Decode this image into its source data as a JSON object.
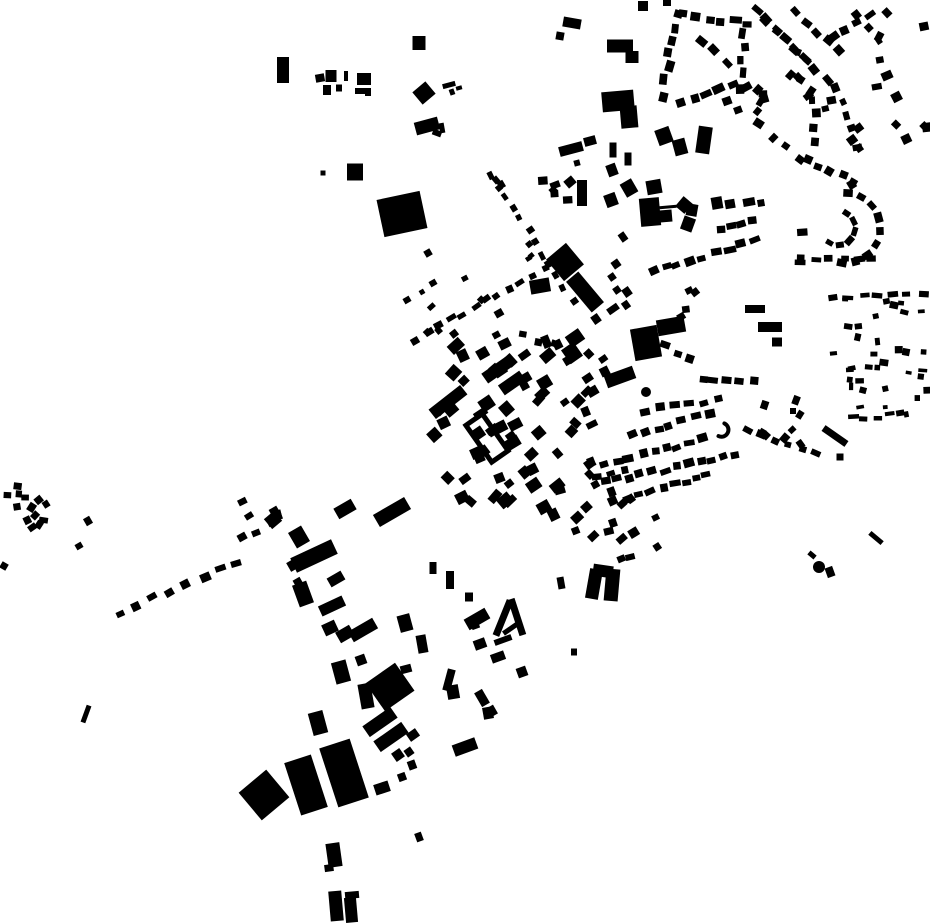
{
  "map": {
    "description": "black-and-white figure-ground map of building footprints of a town, black buildings on white background, no text or labels visible",
    "canvas": {
      "width": 930,
      "height": 924,
      "background": "#ffffff",
      "building_color": "#000000"
    },
    "seed": 7,
    "legend": {
      "buildings": "[cx, cy, w, h, rotationDeg] explicit footprint rectangles",
      "rows": "[x1, y1, x2, y2, count, w, h] houses evenly spaced along a street segment, oriented along it",
      "arcs": "[cx, cy, r, a1Deg, a2Deg, count, w, h] houses along a curved street (loop / cul-de-sac)",
      "scatters": "[x, y, boxW, boxH, count, minSize, maxSize, angleDeg, angleJitterDeg] loose clusters of houses",
      "circles": "[cx, cy, r] round structures",
      "rings": "[cx, cy, w, h, rotationDeg, strokeW] courtyard block outline",
      "crescents": "[cx, cy, r, a1Deg, a2Deg, strokeW] crescent-shaped building"
    },
    "buildings": [
      [
        283,
        70,
        12,
        26,
        0
      ],
      [
        320,
        78,
        9,
        8,
        -10
      ],
      [
        331,
        76,
        11,
        12,
        0
      ],
      [
        327,
        90,
        8,
        10,
        0
      ],
      [
        339,
        88,
        6,
        7,
        0
      ],
      [
        346,
        76,
        4,
        10,
        0
      ],
      [
        364,
        79,
        14,
        12,
        0
      ],
      [
        360,
        91,
        10,
        6,
        0
      ],
      [
        368,
        92,
        6,
        8,
        0
      ],
      [
        419,
        43,
        13,
        14,
        0
      ],
      [
        424,
        93,
        17,
        16,
        -40
      ],
      [
        449,
        85,
        13,
        5,
        -15
      ],
      [
        459,
        88,
        6,
        4,
        -15
      ],
      [
        427,
        126,
        24,
        13,
        -15
      ],
      [
        437,
        133,
        9,
        6,
        20
      ],
      [
        355,
        172,
        16,
        17,
        0
      ],
      [
        323,
        173,
        5,
        5,
        0
      ],
      [
        402,
        214,
        44,
        38,
        -12
      ],
      [
        452,
        92,
        5,
        6,
        -20
      ],
      [
        442,
        128,
        5,
        10,
        -10
      ],
      [
        572,
        23,
        18,
        10,
        10
      ],
      [
        560,
        36,
        8,
        8,
        10
      ],
      [
        643,
        6,
        10,
        10,
        0
      ],
      [
        667,
        3,
        8,
        6,
        0
      ],
      [
        620,
        46,
        26,
        13,
        0
      ],
      [
        632,
        57,
        13,
        12,
        0
      ],
      [
        618,
        101,
        32,
        20,
        -5
      ],
      [
        629,
        117,
        17,
        22,
        -5
      ],
      [
        590,
        141,
        12,
        9,
        -15
      ],
      [
        571,
        149,
        24,
        10,
        -15
      ],
      [
        577,
        163,
        6,
        6,
        -15
      ],
      [
        613,
        150,
        7,
        15,
        0
      ],
      [
        628,
        159,
        7,
        13,
        0
      ],
      [
        612,
        170,
        10,
        12,
        -20
      ],
      [
        629,
        188,
        13,
        15,
        -30
      ],
      [
        611,
        200,
        12,
        13,
        -20
      ],
      [
        582,
        193,
        10,
        26,
        0
      ],
      [
        570,
        182,
        10,
        9,
        -40
      ],
      [
        553,
        190,
        7,
        6,
        -40
      ],
      [
        496,
        180,
        6,
        7,
        -40
      ],
      [
        499,
        188,
        6,
        6,
        -40
      ],
      [
        704,
        140,
        14,
        27,
        8
      ],
      [
        664,
        136,
        15,
        16,
        -20
      ],
      [
        680,
        147,
        13,
        16,
        -15
      ],
      [
        654,
        187,
        15,
        14,
        -10
      ],
      [
        650,
        212,
        20,
        28,
        -5
      ],
      [
        666,
        216,
        12,
        12,
        -5
      ],
      [
        668,
        207,
        17,
        3,
        -5
      ],
      [
        684,
        205,
        12,
        13,
        40
      ],
      [
        692,
        210,
        11,
        12,
        10
      ],
      [
        688,
        224,
        12,
        14,
        20
      ],
      [
        717,
        203,
        11,
        12,
        -10
      ],
      [
        730,
        204,
        10,
        9,
        -10
      ],
      [
        749,
        202,
        12,
        8,
        -10
      ],
      [
        761,
        203,
        7,
        7,
        -10
      ],
      [
        727,
        101,
        9,
        8,
        -20
      ],
      [
        738,
        110,
        8,
        7,
        -20
      ],
      [
        565,
        262,
        26,
        28,
        -40
      ],
      [
        585,
        292,
        16,
        40,
        -40
      ],
      [
        540,
        286,
        20,
        14,
        -10
      ],
      [
        616,
        264,
        8,
        8,
        -35
      ],
      [
        612,
        277,
        7,
        7,
        -35
      ],
      [
        617,
        290,
        7,
        7,
        -35
      ],
      [
        627,
        292,
        8,
        9,
        -35
      ],
      [
        626,
        305,
        7,
        8,
        -35
      ],
      [
        613,
        309,
        12,
        7,
        -35
      ],
      [
        596,
        319,
        8,
        9,
        -35
      ],
      [
        623,
        237,
        7,
        9,
        -35
      ],
      [
        646,
        343,
        27,
        32,
        -10
      ],
      [
        671,
        326,
        28,
        16,
        -10
      ],
      [
        620,
        377,
        30,
        13,
        -20
      ],
      [
        755,
        309,
        20,
        8,
        0
      ],
      [
        770,
        327,
        24,
        10,
        0
      ],
      [
        777,
        342,
        10,
        9,
        0
      ],
      [
        835,
        436,
        28,
        7,
        35
      ],
      [
        840,
        457,
        7,
        7,
        0
      ],
      [
        876,
        538,
        16,
        5,
        40
      ],
      [
        812,
        555,
        8,
        5,
        40
      ],
      [
        830,
        572,
        8,
        10,
        -20
      ],
      [
        793,
        411,
        6,
        6,
        0
      ],
      [
        572,
        353,
        15,
        17,
        -35
      ],
      [
        575,
        338,
        16,
        13,
        -35
      ],
      [
        497,
        370,
        30,
        12,
        -35
      ],
      [
        512,
        383,
        26,
        12,
        -35
      ],
      [
        448,
        402,
        40,
        12,
        -38
      ],
      [
        428,
        253,
        7,
        7,
        -30
      ],
      [
        433,
        283,
        7,
        6,
        -30
      ],
      [
        422,
        292,
        5,
        5,
        -30
      ],
      [
        407,
        300,
        7,
        6,
        -30
      ],
      [
        415,
        341,
        8,
        7,
        -30
      ],
      [
        345,
        509,
        20,
        12,
        -30
      ],
      [
        392,
        512,
        36,
        14,
        -30
      ],
      [
        299,
        537,
        15,
        18,
        -30
      ],
      [
        314,
        556,
        45,
        16,
        -25
      ],
      [
        303,
        594,
        15,
        23,
        -20
      ],
      [
        336,
        579,
        16,
        10,
        -30
      ],
      [
        332,
        606,
        26,
        11,
        -25
      ],
      [
        330,
        628,
        14,
        12,
        -25
      ],
      [
        345,
        634,
        16,
        12,
        -30
      ],
      [
        363,
        630,
        28,
        12,
        -30
      ],
      [
        341,
        672,
        15,
        22,
        -15
      ],
      [
        361,
        660,
        10,
        10,
        -20
      ],
      [
        390,
        687,
        36,
        34,
        -35
      ],
      [
        366,
        696,
        13,
        25,
        -10
      ],
      [
        318,
        723,
        15,
        23,
        -15
      ],
      [
        405,
        623,
        13,
        17,
        -15
      ],
      [
        422,
        644,
        10,
        18,
        -10
      ],
      [
        406,
        669,
        11,
        8,
        -15
      ],
      [
        380,
        722,
        34,
        13,
        -35
      ],
      [
        391,
        737,
        34,
        13,
        -35
      ],
      [
        398,
        755,
        10,
        10,
        -35
      ],
      [
        413,
        735,
        11,
        9,
        -35
      ],
      [
        409,
        752,
        8,
        8,
        -35
      ],
      [
        412,
        765,
        8,
        9,
        -20
      ],
      [
        402,
        777,
        8,
        8,
        -20
      ],
      [
        264,
        795,
        36,
        36,
        -40
      ],
      [
        306,
        785,
        28,
        55,
        -18
      ],
      [
        344,
        773,
        32,
        62,
        -18
      ],
      [
        347,
        787,
        7,
        7,
        -18
      ],
      [
        382,
        788,
        15,
        11,
        -18
      ],
      [
        419,
        837,
        7,
        9,
        -20
      ],
      [
        334,
        855,
        14,
        24,
        -8
      ],
      [
        329,
        868,
        9,
        7,
        -8
      ],
      [
        336,
        906,
        13,
        30,
        -5
      ],
      [
        352,
        895,
        14,
        7,
        -5
      ],
      [
        351,
        910,
        12,
        25,
        -5
      ],
      [
        449,
        680,
        8,
        22,
        15
      ],
      [
        453,
        692,
        12,
        14,
        -10
      ],
      [
        482,
        698,
        9,
        16,
        -30
      ],
      [
        492,
        711,
        8,
        10,
        -30
      ],
      [
        488,
        713,
        10,
        12,
        -10
      ],
      [
        465,
        747,
        24,
        12,
        -20
      ],
      [
        475,
        625,
        8,
        8,
        -20
      ],
      [
        480,
        644,
        12,
        10,
        -20
      ],
      [
        503,
        640,
        18,
        6,
        -20
      ],
      [
        498,
        657,
        14,
        9,
        -20
      ],
      [
        522,
        672,
        10,
        10,
        -20
      ],
      [
        450,
        580,
        8,
        18,
        0
      ],
      [
        469,
        597,
        8,
        9,
        0
      ],
      [
        433,
        568,
        7,
        12,
        0
      ],
      [
        574,
        652,
        6,
        7,
        0
      ],
      [
        561,
        583,
        7,
        12,
        -10
      ],
      [
        594,
        584,
        13,
        30,
        10
      ],
      [
        612,
        585,
        14,
        32,
        5
      ],
      [
        603,
        571,
        20,
        12,
        8
      ],
      [
        503,
        618,
        7,
        38,
        22
      ],
      [
        517,
        617,
        7,
        38,
        -18
      ],
      [
        510,
        629,
        16,
        5,
        -35
      ],
      [
        477,
        619,
        24,
        12,
        -30
      ],
      [
        88,
        521,
        7,
        8,
        -30
      ],
      [
        79,
        546,
        7,
        6,
        -30
      ],
      [
        86,
        714,
        5,
        18,
        20
      ],
      [
        4,
        566,
        7,
        7,
        30
      ],
      [
        293,
        565,
        10,
        10,
        -30
      ],
      [
        299,
        584,
        8,
        12,
        -30
      ],
      [
        273,
        520,
        13,
        13,
        -40
      ]
    ],
    "rows": [
      [
        663,
        95,
        676,
        14,
        7,
        9,
        7
      ],
      [
        684,
        14,
        748,
        24,
        6,
        10,
        7
      ],
      [
        744,
        32,
        741,
        88,
        5,
        9,
        7
      ],
      [
        681,
        103,
        733,
        84,
        5,
        10,
        7
      ],
      [
        700,
        41,
        726,
        62,
        3,
        9,
        7
      ],
      [
        757,
        10,
        826,
        80,
        8,
        10,
        7
      ],
      [
        766,
        22,
        816,
        68,
        6,
        9,
        7
      ],
      [
        797,
        12,
        838,
        52,
        5,
        9,
        7
      ],
      [
        858,
        14,
        880,
        40,
        3,
        9,
        7
      ],
      [
        832,
        38,
        872,
        15,
        4,
        9,
        7
      ],
      [
        808,
        160,
        853,
        180,
        5,
        9,
        7
      ],
      [
        814,
        100,
        816,
        140,
        4,
        8,
        7
      ],
      [
        836,
        90,
        850,
        130,
        4,
        8,
        7
      ],
      [
        758,
        125,
        800,
        160,
        4,
        8,
        7
      ],
      [
        800,
        262,
        872,
        259,
        6,
        9,
        6
      ],
      [
        803,
        232,
        803,
        255,
        2,
        6,
        9
      ],
      [
        652,
        272,
        755,
        242,
        9,
        10,
        7
      ],
      [
        720,
        227,
        752,
        222,
        4,
        9,
        7
      ],
      [
        664,
        346,
        692,
        358,
        3,
        9,
        7
      ],
      [
        702,
        377,
        752,
        381,
        5,
        9,
        7
      ],
      [
        646,
        411,
        716,
        399,
        6,
        9,
        7
      ],
      [
        633,
        436,
        708,
        413,
        7,
        9,
        7
      ],
      [
        605,
        465,
        703,
        440,
        9,
        9,
        7
      ],
      [
        599,
        476,
        627,
        469,
        3,
        8,
        6
      ],
      [
        605,
        483,
        737,
        455,
        12,
        9,
        7
      ],
      [
        627,
        498,
        708,
        473,
        8,
        9,
        7
      ],
      [
        748,
        428,
        815,
        455,
        6,
        8,
        7
      ],
      [
        790,
        430,
        800,
        443,
        2,
        7,
        6
      ],
      [
        492,
        174,
        572,
        300,
        12,
        7,
        6
      ],
      [
        545,
        268,
        427,
        333,
        11,
        8,
        6
      ],
      [
        523,
        336,
        553,
        345,
        3,
        9,
        7
      ],
      [
        120,
        613,
        237,
        563,
        8,
        9,
        7
      ],
      [
        240,
        537,
        272,
        524,
        3,
        8,
        7
      ],
      [
        835,
        297,
        922,
        293,
        7,
        10,
        5
      ],
      [
        852,
        418,
        900,
        415,
        5,
        9,
        5
      ]
    ],
    "arcs": [
      [
        845,
        228,
        35,
        -85,
        95,
        9,
        9,
        7
      ],
      [
        838,
        228,
        17,
        -60,
        120,
        6,
        8,
        6
      ]
    ],
    "scatters": [
      [
        746,
        85,
        46,
        30,
        5,
        7,
        10,
        -30,
        30
      ],
      [
        855,
        10,
        75,
        140,
        11,
        7,
        11,
        -35,
        30
      ],
      [
        805,
        85,
        65,
        100,
        6,
        7,
        10,
        -40,
        30
      ],
      [
        750,
        40,
        100,
        70,
        8,
        7,
        10,
        -40,
        30
      ],
      [
        540,
        170,
        35,
        42,
        4,
        7,
        10,
        -15,
        20
      ],
      [
        2,
        482,
        53,
        46,
        13,
        6,
        9,
        -30,
        40
      ],
      [
        238,
        500,
        42,
        20,
        5,
        7,
        9,
        -30,
        20
      ],
      [
        445,
        340,
        115,
        55,
        16,
        8,
        15,
        -35,
        15
      ],
      [
        430,
        390,
        115,
        60,
        18,
        8,
        15,
        -35,
        15
      ],
      [
        440,
        450,
        120,
        70,
        20,
        8,
        14,
        -35,
        15
      ],
      [
        545,
        350,
        65,
        120,
        16,
        7,
        12,
        -35,
        15
      ],
      [
        555,
        470,
        85,
        75,
        12,
        7,
        11,
        -30,
        15
      ],
      [
        600,
        495,
        60,
        65,
        7,
        7,
        10,
        -25,
        15
      ],
      [
        420,
        270,
        80,
        75,
        8,
        6,
        9,
        -35,
        15
      ],
      [
        833,
        290,
        95,
        132,
        34,
        4,
        9,
        0,
        15
      ],
      [
        760,
        380,
        45,
        65,
        6,
        7,
        9,
        -60,
        20
      ],
      [
        655,
        280,
        45,
        40,
        4,
        7,
        9,
        -20,
        20
      ],
      [
        515,
        240,
        20,
        35,
        3,
        5,
        7,
        -40,
        15
      ]
    ],
    "circles": [
      [
        646,
        392,
        5
      ],
      [
        819,
        567,
        6
      ]
    ],
    "rings": [
      [
        487,
        438,
        20,
        45,
        -35,
        5
      ]
    ],
    "crescents": [
      [
        722,
        430,
        7,
        -70,
        120,
        4
      ]
    ]
  }
}
